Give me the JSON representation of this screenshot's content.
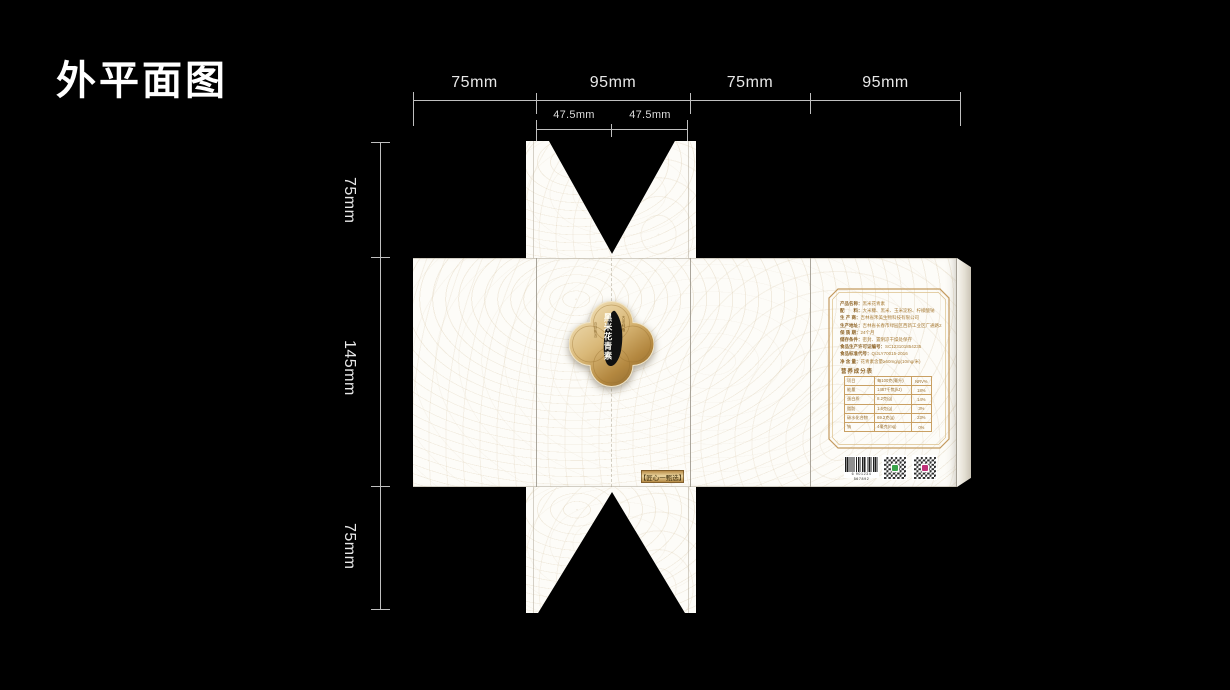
{
  "title": "外平面图",
  "dims": {
    "top": [
      "75mm",
      "95mm",
      "75mm",
      "95mm"
    ],
    "sub": [
      "47.5mm",
      "47.5mm"
    ],
    "left": [
      "75mm",
      "145mm",
      "75mm"
    ]
  },
  "emblem": {
    "main": "黑米花青素",
    "side_right": "古法种植",
    "side_left": "自然甄选"
  },
  "front_badge": "【匠心一甄选】",
  "info": {
    "fields": [
      {
        "label": "产品名称：",
        "value": "黑米花青素"
      },
      {
        "label": "配　　料：",
        "value": "大米糠、黑米、玉米淀粉、柠檬酸钠"
      },
      {
        "label": "生 产 商：",
        "value": "吉林省禾美生物科技有限公司"
      },
      {
        "label": "生产地址：",
        "value": "吉林省长春市绿园区西新工业区广通路219号"
      },
      {
        "label": "保 质 期：",
        "value": "24个月"
      },
      {
        "label": "储存条件：",
        "value": "密封、置阴凉干燥处保存"
      },
      {
        "label": "食品生产许可证编号：",
        "value": "SC123101854235"
      },
      {
        "label": "食品标准代号：",
        "value": "Q/JLY70015-2016"
      },
      {
        "label": "净 含 量：",
        "value": "花青素含量≥60mg/g(10mg/米)"
      }
    ],
    "nutrition": {
      "title": "营养成分表",
      "rows": [
        [
          "项目",
          "每100克(毫升)",
          "NRV%"
        ],
        [
          "能量",
          "1487千焦(kJ)",
          "18%"
        ],
        [
          "蛋白质",
          "8.2克(g)",
          "14%"
        ],
        [
          "脂肪",
          "1.6克(g)",
          "3%"
        ],
        [
          "碳水化合物",
          "69.2克(g)",
          "23%"
        ],
        [
          "钠",
          "4毫克(mg)",
          "0%"
        ]
      ]
    }
  },
  "barcode": {
    "number": "6 901234 567892"
  },
  "colors": {
    "background": "#000000",
    "panel": "#fdfcf8",
    "dim_line": "#bfbfbf",
    "gold_frame": "#c49a5e",
    "gold_dark": "#8f6a30",
    "info_text": "#9a6f2e",
    "qr_center_green": "#3aa34a",
    "qr_center_magenta": "#bf3078"
  }
}
